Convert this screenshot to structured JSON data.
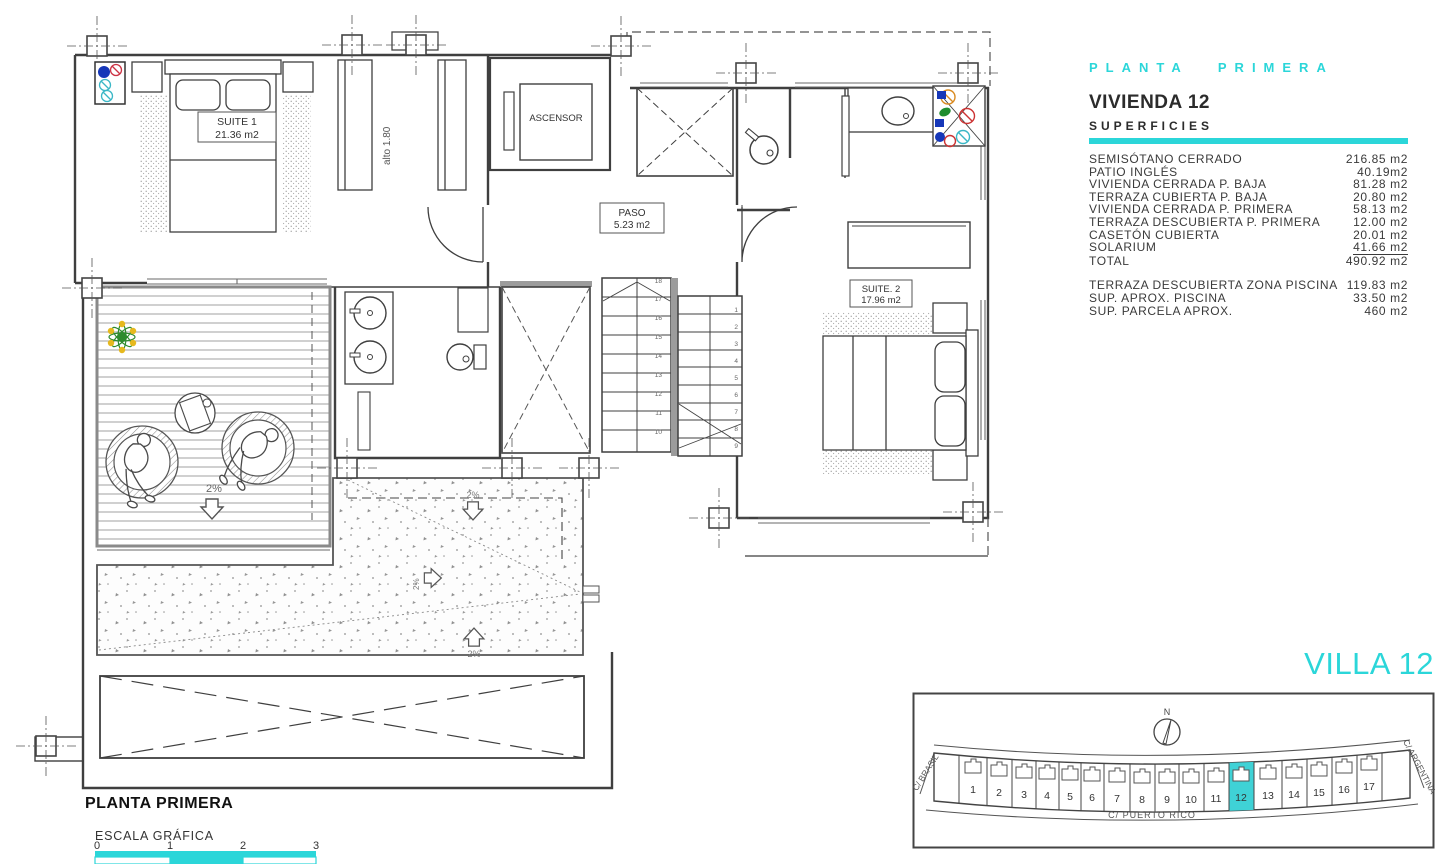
{
  "panel": {
    "title": "PLANTA PRIMERA",
    "vivienda": "VIVIENDA 12",
    "superficies": "SUPERFICIES",
    "rows": [
      {
        "label": "SEMISÓTANO CERRADO",
        "value": "216.85 m2"
      },
      {
        "label": "PATIO INGLÉS",
        "value": "40.19m2"
      },
      {
        "label": "VIVIENDA CERRADA P. BAJA",
        "value": "81.28 m2"
      },
      {
        "label": "TERRAZA CUBIERTA P. BAJA",
        "value": "20.80 m2"
      },
      {
        "label": "VIVIENDA CERRADA P. PRIMERA",
        "value": "58.13 m2"
      },
      {
        "label": "TERRAZA DESCUBIERTA P. PRIMERA",
        "value": "12.00 m2"
      },
      {
        "label": "CASETÓN CUBIERTA",
        "value": "20.01 m2"
      },
      {
        "label": "SOLARIUM",
        "value": "41.66 m2"
      },
      {
        "label": "TOTAL",
        "value": "490.92 m2"
      }
    ],
    "rows_secondary": [
      {
        "label": "TERRAZA DESCUBIERTA ZONA PISCINA",
        "value": "119.83 m2"
      },
      {
        "label": "SUP. APROX. PISCINA",
        "value": "33.50 m2"
      },
      {
        "label": "SUP. PARCELA APROX.",
        "value": "460 m2"
      }
    ]
  },
  "plan": {
    "suite1_name": "SUITE 1",
    "suite1_area": "21.36 m2",
    "suite2_name": "SUITE. 2",
    "suite2_area": "17.96 m2",
    "paso_name": "PASO",
    "paso_area": "5.23 m2",
    "ascensor": "ASCENSOR",
    "alto": "alto 1.80",
    "slope": "2%",
    "stairs_left": [
      "18",
      "17",
      "16",
      "15",
      "14",
      "13",
      "12",
      "11",
      "10"
    ],
    "stairs_right": [
      "1",
      "2",
      "3",
      "4",
      "5",
      "6",
      "7",
      "8",
      "9"
    ],
    "footer_title": "PLANTA PRIMERA",
    "scale_label": "ESCALA GRÁFICA",
    "scale_ticks": [
      "0",
      "1",
      "2",
      "3"
    ]
  },
  "siteplan": {
    "heading": "VILLA 12",
    "compass": "N",
    "street_left": "C/  BRASIL",
    "street_right": "C/  ARGENTINA",
    "street_bottom": "C/  PUERTO RICO",
    "plots": [
      "1",
      "2",
      "3",
      "4",
      "5",
      "6",
      "7",
      "8",
      "9",
      "10",
      "11",
      "12",
      "13",
      "14",
      "15",
      "16",
      "17"
    ],
    "highlighted_plot": "12"
  },
  "colors": {
    "accent": "#2bd6d9",
    "line": "#3f3f3f",
    "highlight_fill": "#3fd2d6"
  }
}
